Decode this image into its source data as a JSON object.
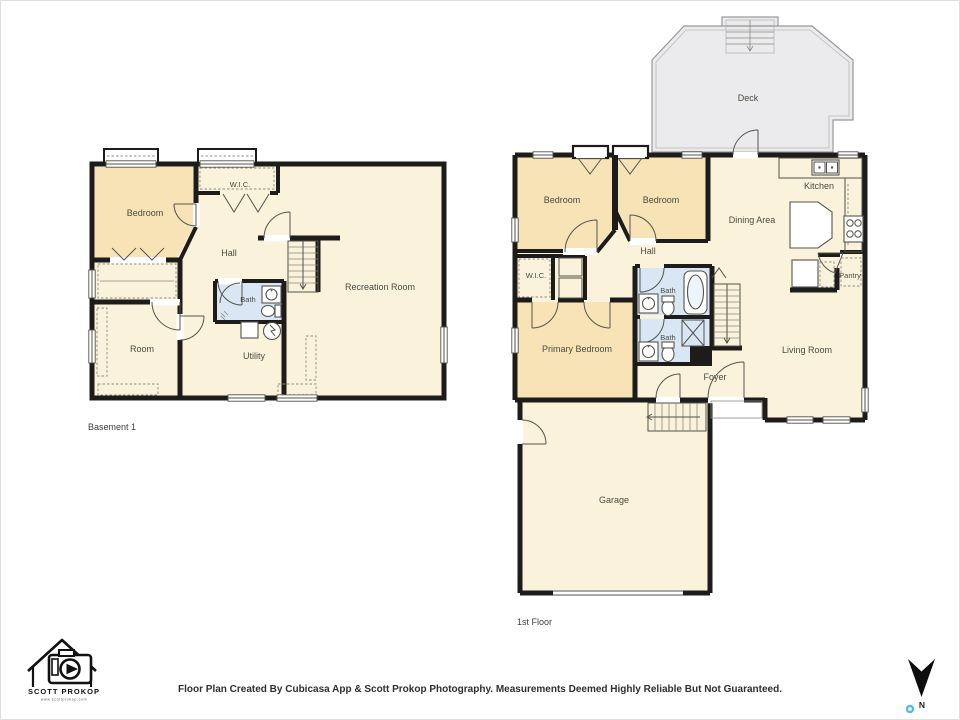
{
  "document": {
    "type": "Residential Floor Plan"
  },
  "basement": {
    "title": "Basement 1",
    "rooms": {
      "bedroom": "Bedroom",
      "wic": "W.I.C.",
      "hall": "Hall",
      "recreation_room": "Recreation Room",
      "bath": "Bath",
      "room": "Room",
      "utility": "Utility"
    }
  },
  "first_floor": {
    "title": "1st Floor",
    "rooms": {
      "deck": "Deck",
      "bedroom_left": "Bedroom",
      "bedroom_right": "Bedroom",
      "kitchen": "Kitchen",
      "dining_area": "Dining Area",
      "hall": "Hall",
      "wic": "W.I.C.",
      "bath_upper": "Bath",
      "bath_lower": "Bath",
      "primary_bedroom": "Primary Bedroom",
      "pantry": "Pantry",
      "living_room": "Living Room",
      "foyer": "Foyer",
      "garage": "Garage"
    }
  },
  "branding": {
    "name": "SCOTT PROKOP",
    "website": "www.scottprokop.com"
  },
  "footer": {
    "disclaimer": "Floor Plan Created By Cubicasa App & Scott Prokop Photography. Measurements Deemed Highly Reliable But Not Guaranteed."
  },
  "compass": {
    "north_label": "N"
  },
  "colors": {
    "wall": "#1d1c1a",
    "room_default": "#faf2db",
    "room_accent_tan": "#f8e3b6",
    "bathroom_blue": "#d9e7f5",
    "deck_gray": "#ebebed"
  }
}
